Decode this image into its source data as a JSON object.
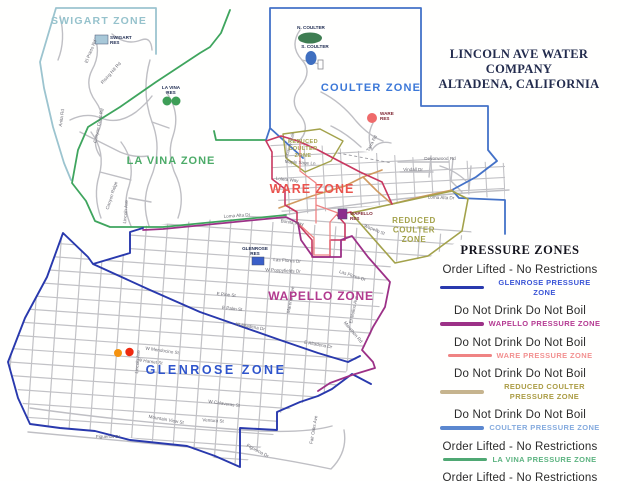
{
  "title": {
    "line1": "LINCOLN AVE WATER COMPANY",
    "line2": "ALTADENA, CALIFORNIA",
    "color": "#232c4e"
  },
  "legend": {
    "title": "PRESSURE ZONES",
    "entries": [
      {
        "status": "Order Lifted - No Restrictions",
        "zone": "GLENROSE PRESSURE ZONE",
        "line_color": "#2939ad",
        "text_color": "#3b55d6"
      },
      {
        "status": "Do Not Drink Do Not Boil",
        "zone": "WAPELLO PRESSURE ZONE",
        "line_color": "#9c3187",
        "text_color": "#b43a92"
      },
      {
        "status": "Do Not Drink Do Not Boil",
        "zone": "WARE PRESSURE ZONE",
        "line_color": "#ef8383",
        "text_color": "#f29090"
      },
      {
        "status": "Do Not Drink Do Not Boil",
        "zone": "REDUCED COULTER PRESSURE ZONE",
        "line_color": "#c6b48e",
        "text_color": "#ab9c45"
      },
      {
        "status": "Do Not Drink Do Not Boil",
        "zone": "COULTER PRESSURE ZONE",
        "line_color": "#5b87cf",
        "text_color": "#85abde"
      },
      {
        "status": "Order Lifted - No Restrictions",
        "zone": "LA VINA PRESSURE ZONE",
        "line_color": "#4fa873",
        "text_color": "#5cb380"
      },
      {
        "status": "Order Lifted - No Restrictions",
        "zone": "SWIGART PRESSURE ZONE",
        "line_color": "#a9c0d2",
        "text_color": "#b5c8d5"
      }
    ]
  },
  "colors": {
    "swigart": "#9cc4cf",
    "lavina": "#3fa55e",
    "coulter": "#4472c8",
    "glenrose": "#2939ad",
    "wapello": "#9c3187",
    "ware_outer": "#c8375f",
    "ware": "#ef8383",
    "reduced_coulter": "#a3a24b",
    "tan_line": "#d09a5f",
    "street": "#c2c2c6",
    "road": "#bfbfc4"
  },
  "map": {
    "zone_labels": [
      {
        "lines": [
          "SWIGART ZONE"
        ],
        "x": 99,
        "y": 24,
        "size": 10.5,
        "spacing": 1.2,
        "color": "#96c2cc"
      },
      {
        "lines": [
          "COULTER ZONE"
        ],
        "x": 371,
        "y": 91,
        "size": 11,
        "spacing": 1.2,
        "color": "#3c78d8"
      },
      {
        "lines": [
          "LA VINA ZONE"
        ],
        "x": 171,
        "y": 164,
        "size": 11,
        "spacing": 1,
        "color": "#4cab68"
      },
      {
        "lines": [
          "WARE ZONE"
        ],
        "x": 312,
        "y": 193,
        "size": 12.5,
        "spacing": 1,
        "color": "#ea544e"
      },
      {
        "lines": [
          "REDUCED",
          "COULTER",
          "ZONE"
        ],
        "x": 303,
        "y": 143,
        "size": 5.5,
        "spacing": 0.4,
        "color": "#a3a24b"
      },
      {
        "lines": [
          "WAPELLO ZONE"
        ],
        "x": 321,
        "y": 300,
        "size": 12,
        "spacing": 0.8,
        "color": "#b13a8e"
      },
      {
        "lines": [
          "GLENROSE ZONE"
        ],
        "x": 216,
        "y": 374,
        "size": 12.5,
        "spacing": 2.5,
        "color": "#2f55cc"
      },
      {
        "lines": [
          "REDUCED",
          "COULTER",
          "ZONE"
        ],
        "x": 414,
        "y": 223,
        "size": 8,
        "spacing": 0.6,
        "color": "#a3a24b"
      }
    ],
    "reservoirs": [
      {
        "label": [
          "SWIGART",
          "RES"
        ],
        "lx": 110,
        "ly": 39,
        "anchor": "start",
        "label_color": "#1d2a50",
        "type": "rect",
        "x": 95,
        "y": 35,
        "w": 13,
        "h": 9,
        "color": "#a8c8d8"
      },
      {
        "label": [
          "N. COULTER"
        ],
        "lx": 311,
        "ly": 29,
        "anchor": "middle",
        "label_color": "#1d2a50",
        "type": "ellipse",
        "cx": 310,
        "cy": 38,
        "rx": 12,
        "ry": 5.5,
        "color": "#3e7d52"
      },
      {
        "label": [
          "S. COULTER"
        ],
        "lx": 315,
        "ly": 48,
        "anchor": "middle",
        "label_color": "#1d2a50",
        "type": "ellipse",
        "cx": 311,
        "cy": 58,
        "rx": 5.5,
        "ry": 7,
        "color": "#3f6fc0"
      },
      {
        "label": [
          "LA VINA",
          "RES"
        ],
        "lx": 171,
        "ly": 89,
        "anchor": "middle",
        "label_color": "#1d2a50",
        "type": "twodots",
        "cx": 167,
        "cy": 101,
        "r": 4.5,
        "dx": 9,
        "color": "#3e9e57"
      },
      {
        "label": [
          "WARE",
          "RES"
        ],
        "lx": 380,
        "ly": 115,
        "anchor": "start",
        "label_color": "#7d2430",
        "type": "circle",
        "cx": 372,
        "cy": 118,
        "r": 5,
        "color": "#ef6a6a"
      },
      {
        "label": [
          "GLENROSE",
          "RES"
        ],
        "lx": 255,
        "ly": 250,
        "anchor": "middle",
        "label_color": "#1d2a50",
        "type": "rect",
        "x": 252,
        "y": 257,
        "w": 12,
        "h": 8,
        "color": "#3a5fc8"
      },
      {
        "label": [
          "WAPELLO",
          "RES"
        ],
        "lx": 350,
        "ly": 215,
        "anchor": "start",
        "label_color": "#7d2430",
        "type": "rect",
        "x": 338,
        "y": 209,
        "w": 9,
        "h": 10,
        "color": "#8c2d8c"
      }
    ],
    "streets": [
      {
        "name": "El Prieto Rd",
        "x": 92,
        "y": 52,
        "rot": -68
      },
      {
        "name": "Rising Hill Rd",
        "x": 112,
        "y": 74,
        "rot": -48
      },
      {
        "name": "Anita Rd",
        "x": 63,
        "y": 118,
        "rot": -82
      },
      {
        "name": "Canyon Crest Rd",
        "x": 100,
        "y": 126,
        "rot": -78
      },
      {
        "name": "Canyon Ridge",
        "x": 113,
        "y": 196,
        "rot": -72
      },
      {
        "name": "Lincoln Ave",
        "x": 127,
        "y": 212,
        "rot": -85
      },
      {
        "name": "Chaney Trail",
        "x": 291,
        "y": 146,
        "rot": -75
      },
      {
        "name": "Tarra Rd",
        "x": 373,
        "y": 144,
        "rot": -62
      },
      {
        "name": "Loleta Way",
        "x": 287,
        "y": 181,
        "rot": 6
      },
      {
        "name": "Maple Sage Ln",
        "x": 300,
        "y": 164,
        "rot": 4
      },
      {
        "name": "Loma Alta Dr",
        "x": 237,
        "y": 217,
        "rot": -4
      },
      {
        "name": "Loma Alta Dr",
        "x": 441,
        "y": 199,
        "rot": 2
      },
      {
        "name": "Devonwood Rd",
        "x": 440,
        "y": 160,
        "rot": 0
      },
      {
        "name": "Vindall Dr",
        "x": 413,
        "y": 171,
        "rot": 0
      },
      {
        "name": "Bonita Way",
        "x": 292,
        "y": 224,
        "rot": 8
      },
      {
        "name": "Wapello St",
        "x": 374,
        "y": 231,
        "rot": 22
      },
      {
        "name": "Las Flores Dr",
        "x": 287,
        "y": 262,
        "rot": 4
      },
      {
        "name": "W Poppyfields Dr",
        "x": 283,
        "y": 272,
        "rot": 3
      },
      {
        "name": "Las Flores Dr",
        "x": 352,
        "y": 277,
        "rot": 18
      },
      {
        "name": "Marathon Rd",
        "x": 352,
        "y": 333,
        "rot": 50
      },
      {
        "name": "W Altadena Dr",
        "x": 250,
        "y": 328,
        "rot": 10
      },
      {
        "name": "E Altadena Dr",
        "x": 318,
        "y": 346,
        "rot": 10
      },
      {
        "name": "W Mendocino St",
        "x": 162,
        "y": 352,
        "rot": 8
      },
      {
        "name": "W Harriet St",
        "x": 150,
        "y": 363,
        "rot": 8
      },
      {
        "name": "Mountain View St",
        "x": 166,
        "y": 421,
        "rot": 10
      },
      {
        "name": "Ventura St",
        "x": 213,
        "y": 422,
        "rot": 4
      },
      {
        "name": "W Calaveras St",
        "x": 224,
        "y": 405,
        "rot": 8
      },
      {
        "name": "Figueroa Dr",
        "x": 108,
        "y": 438,
        "rot": 0
      },
      {
        "name": "Figueroa Dr",
        "x": 257,
        "y": 452,
        "rot": 28
      },
      {
        "name": "E Palm St",
        "x": 232,
        "y": 310,
        "rot": 6
      },
      {
        "name": "E Pine St",
        "x": 226,
        "y": 296,
        "rot": 6
      },
      {
        "name": "Lincoln Ave",
        "x": 139,
        "y": 362,
        "rot": -85
      },
      {
        "name": "Fair Oaks Ave",
        "x": 315,
        "y": 430,
        "rot": -80
      },
      {
        "name": "Marengo Ave",
        "x": 292,
        "y": 300,
        "rot": -80
      },
      {
        "name": "El Molino Ave",
        "x": 355,
        "y": 310,
        "rot": -78
      }
    ],
    "dots": [
      {
        "x": 118,
        "y": 353,
        "r": 4,
        "color": "#f5920e"
      },
      {
        "x": 129.5,
        "y": 352,
        "r": 4.2,
        "color": "#ee2a10"
      }
    ]
  }
}
